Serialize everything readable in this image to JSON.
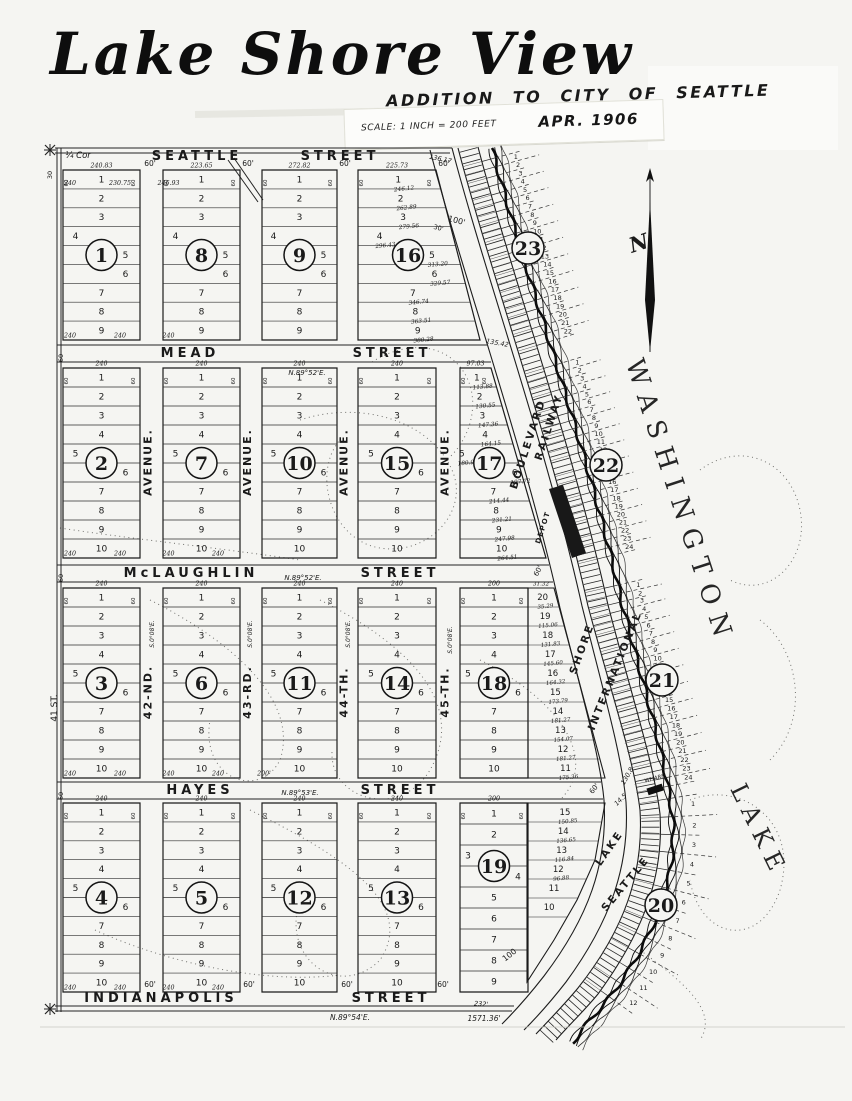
{
  "title": {
    "main": "Lake Shore View",
    "subtitle": "ADDITION TO CITY OF SEATTLE",
    "scale": "SCALE: 1 INCH = 200 FEET",
    "date": "APR. 1906"
  },
  "compass": {
    "label": "N"
  },
  "water": {
    "line1": "LAKE",
    "line2": "WASHINGTON"
  },
  "roads": {
    "boulevard_words": [
      "BOULEVARD",
      "SHORE",
      "LAKE"
    ],
    "railway_words": [
      "RAILWAY",
      "INTERNATIONAL",
      "SEATTLE"
    ],
    "depot": "DEPOT",
    "wharf": "WHARF"
  },
  "streets": [
    {
      "name": "SEATTLE",
      "suffix": "STREET"
    },
    {
      "name": "MEAD",
      "suffix": "STREET"
    },
    {
      "name": "McLAUGHLIN",
      "suffix": "STREET"
    },
    {
      "name": "HAYES",
      "suffix": "STREET"
    },
    {
      "name": "INDIANAPOLIS",
      "suffix": "STREET"
    }
  ],
  "avenues": [
    {
      "upper": "AVENUE.",
      "lower": "42-ND."
    },
    {
      "upper": "AVENUE.",
      "lower": "43-RD."
    },
    {
      "upper": "AVENUE.",
      "lower": "44-TH."
    },
    {
      "upper": "AVENUE.",
      "lower": "45-TH."
    }
  ],
  "blocks": [
    {
      "number": "1",
      "lots": [
        "1",
        "2",
        "3",
        "4",
        "5",
        "6",
        "7",
        "8",
        "9"
      ],
      "top_dim": "240.83",
      "lot1_dim": "240",
      "bottom_dim": "240"
    },
    {
      "number": "8",
      "lots": [
        "1",
        "2",
        "3",
        "4",
        "5",
        "6",
        "7",
        "8",
        "9"
      ],
      "top_dim": "223.65",
      "lot1_dim": "230.75",
      "bottom_dim": "240"
    },
    {
      "number": "9",
      "lots": [
        "1",
        "2",
        "3",
        "4",
        "5",
        "6",
        "7",
        "8",
        "9"
      ],
      "top_dim": "272.82",
      "lot1_dim": "246.93",
      "bottom_dim": "240"
    },
    {
      "number": "16",
      "lots": [
        "1",
        "2",
        "3",
        "4",
        "5",
        "6",
        "7",
        "8",
        "9"
      ],
      "top_dim": "225.73",
      "lot_dims": [
        "246.12",
        "262.89",
        "279.56",
        "296.43",
        "313.20",
        "329.57",
        "346.74",
        "363.51",
        "380.28"
      ]
    },
    {
      "number": "2",
      "lots": [
        "1",
        "2",
        "3",
        "4",
        "5",
        "6",
        "7",
        "8",
        "9",
        "10"
      ],
      "top_dim": "240",
      "bottom_dim": "240"
    },
    {
      "number": "7",
      "lots": [
        "1",
        "2",
        "3",
        "4",
        "5",
        "6",
        "7",
        "8",
        "9",
        "10"
      ],
      "top_dim": "240",
      "bottom_dim": "240"
    },
    {
      "number": "10",
      "lots": [
        "1",
        "2",
        "3",
        "4",
        "5",
        "6",
        "7",
        "8",
        "9",
        "10"
      ],
      "top_dim": "240",
      "bottom_dim": "240"
    },
    {
      "number": "15",
      "lots": [
        "1",
        "2",
        "3",
        "4",
        "5",
        "6",
        "7",
        "8",
        "9",
        "10"
      ],
      "top_dim": "240",
      "bottom_dim": "240"
    },
    {
      "number": "17",
      "lots": [
        "1",
        "2",
        "3",
        "4",
        "5",
        "6",
        "7",
        "8",
        "9",
        "10"
      ],
      "top_dim": "97.03",
      "lot_dims": [
        "113.88",
        "130.55",
        "147.36",
        "164.15",
        "180.94",
        "197.72",
        "214.44",
        "231.21",
        "247.98",
        "264.51"
      ]
    },
    {
      "number": "3",
      "lots": [
        "1",
        "2",
        "3",
        "4",
        "5",
        "6",
        "7",
        "8",
        "9",
        "10"
      ],
      "top_dim": "240",
      "bottom_dim": "240"
    },
    {
      "number": "6",
      "lots": [
        "1",
        "2",
        "3",
        "4",
        "5",
        "6",
        "7",
        "8",
        "9",
        "10"
      ],
      "top_dim": "240",
      "bottom_dim": "240"
    },
    {
      "number": "11",
      "lots": [
        "1",
        "2",
        "3",
        "4",
        "5",
        "6",
        "7",
        "8",
        "9",
        "10"
      ],
      "top_dim": "240",
      "bottom_dim": "240"
    },
    {
      "number": "14",
      "lots": [
        "1",
        "2",
        "3",
        "4",
        "5",
        "6",
        "7",
        "8",
        "9",
        "10"
      ],
      "top_dim": "240",
      "bottom_dim": "240"
    },
    {
      "number": "18",
      "lots": [
        "1",
        "2",
        "3",
        "4",
        "5",
        "6",
        "7",
        "8",
        "9",
        "10"
      ],
      "top_dim": "200",
      "bottom_dim": "200'",
      "right_tier": {
        "top_dim": "31.32",
        "lots": [
          "20",
          "19",
          "18",
          "17",
          "16",
          "15",
          "14",
          "13",
          "12",
          "11"
        ],
        "dims": [
          "35.29",
          "115.06",
          "131.83",
          "145.60",
          "164.32",
          "173.79",
          "181.27",
          "154.07",
          "181.27",
          "175.36"
        ]
      }
    },
    {
      "number": "4",
      "lots": [
        "1",
        "2",
        "3",
        "4",
        "5",
        "6",
        "7",
        "8",
        "9",
        "10"
      ],
      "top_dim": "240",
      "bottom_dim": "240"
    },
    {
      "number": "5",
      "lots": [
        "1",
        "2",
        "3",
        "4",
        "5",
        "6",
        "7",
        "8",
        "9",
        "10"
      ],
      "top_dim": "240",
      "bottom_dim": "240"
    },
    {
      "number": "12",
      "lots": [
        "1",
        "2",
        "3",
        "4",
        "5",
        "6",
        "7",
        "8",
        "9",
        "10"
      ],
      "top_dim": "240",
      "bottom_dim": "240"
    },
    {
      "number": "13",
      "lots": [
        "1",
        "2",
        "3",
        "4",
        "5",
        "6",
        "7",
        "8",
        "9",
        "10"
      ],
      "top_dim": "240",
      "bottom_dim": "240"
    },
    {
      "number": "19",
      "lots": [
        "1",
        "2",
        "3",
        "4",
        "5",
        "6",
        "7",
        "8",
        "9"
      ],
      "top_dim": "200",
      "right_tier": {
        "top_dim": "",
        "lots": [
          "15",
          "14",
          "13",
          "12",
          "11",
          "10"
        ],
        "dims": [
          "150.85",
          "136.65",
          "116.84",
          "96.88",
          "",
          ""
        ]
      }
    }
  ],
  "shore_blocks": [
    {
      "number": "23",
      "lots": [
        "1",
        "2",
        "3",
        "4",
        "5",
        "6",
        "7",
        "8",
        "9",
        "10",
        "11",
        "12",
        "13",
        "14",
        "15",
        "16",
        "17",
        "18",
        "19",
        "20",
        "21",
        "22"
      ]
    },
    {
      "number": "22",
      "lots": [
        "1",
        "2",
        "3",
        "4",
        "5",
        "6",
        "7",
        "8",
        "9",
        "10",
        "11",
        "12",
        "13",
        "14",
        "15",
        "16",
        "17",
        "18",
        "19",
        "20",
        "21",
        "22",
        "23",
        "24"
      ]
    },
    {
      "number": "21",
      "lots": [
        "1",
        "2",
        "3",
        "4",
        "5",
        "6",
        "7",
        "8",
        "9",
        "10",
        "11",
        "12",
        "13",
        "14",
        "15",
        "16",
        "17",
        "18",
        "19",
        "20",
        "21",
        "22",
        "23",
        "24"
      ]
    },
    {
      "number": "20",
      "lots": [
        "1",
        "2",
        "3",
        "4",
        "5",
        "6",
        "7",
        "8",
        "9",
        "10",
        "11",
        "12"
      ]
    }
  ],
  "annotations": [
    "¼ Cor",
    "30",
    "136.17",
    "100'",
    "30'",
    "135.42",
    "130.8",
    "14.5",
    "100",
    "232'",
    "N.89°52'E.",
    "N.89°52'E.",
    "N.89°53'E.",
    "N.89°54'E.",
    "1571.36'",
    "S.0°08'E.",
    "S.0°08'E.",
    "S.0°08'E.",
    "S.0°08'E.",
    "41 ST.",
    "60'",
    "60'",
    "60'",
    "60'",
    "60'",
    "60'",
    "60'",
    "60'",
    "60",
    "60",
    "60",
    "60'",
    "60'"
  ]
}
